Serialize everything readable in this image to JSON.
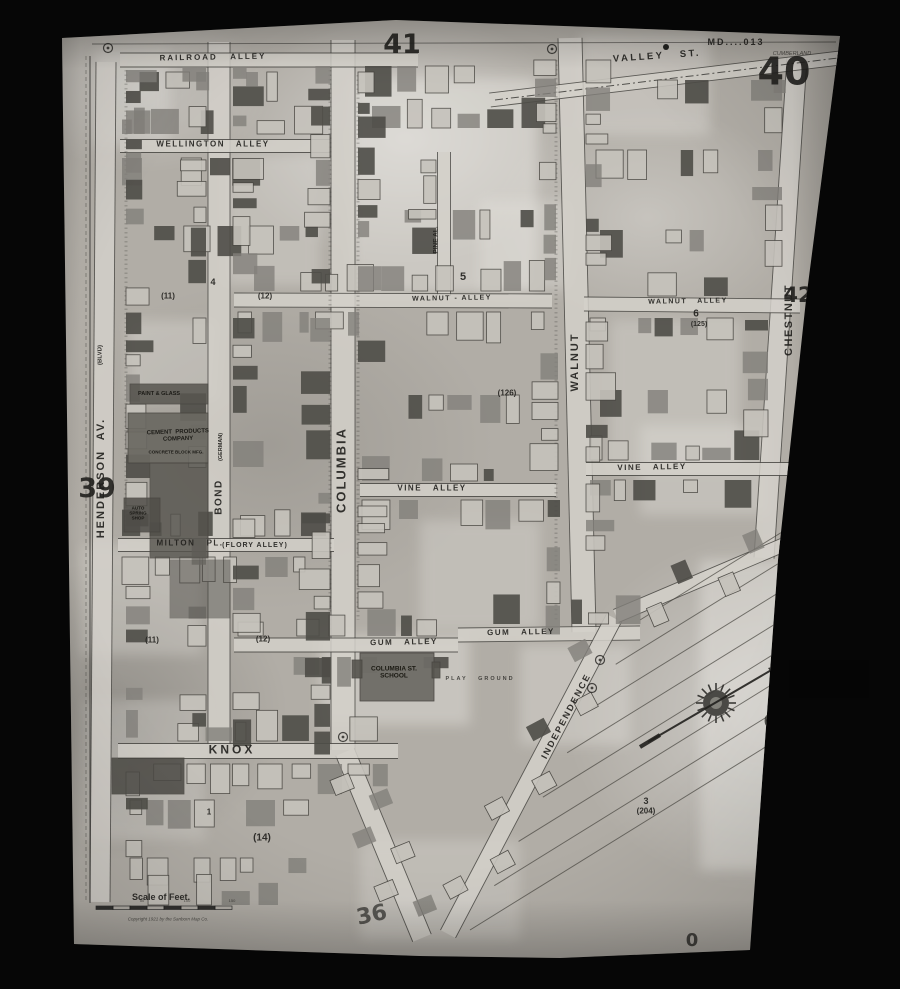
{
  "map_meta": {
    "catalog_number": "MD....013",
    "city": "CUMBERLAND",
    "sheet_number": "40",
    "adjacent_sheets": [
      "39",
      "41",
      "42",
      "36"
    ],
    "scale_label": "Scale of Feet.",
    "scale_ticks": [
      "50",
      "100",
      "150"
    ],
    "copyright": "Copyright 1921 by the Sanborn Map Co."
  },
  "labels": [
    {
      "name": "catalog-number",
      "text": "MD....013",
      "x": 736,
      "y": 42,
      "fs": 9,
      "ls": 2,
      "w": 700
    },
    {
      "name": "city-name",
      "text": "CUMBERLAND",
      "x": 792,
      "y": 54,
      "fs": 5.5,
      "it": 1,
      "o": 0.7
    },
    {
      "name": "sheet-number-40",
      "text": "40",
      "x": 784,
      "y": 72,
      "fs": 38,
      "w": 700,
      "num": 1
    },
    {
      "name": "sheet-number-41",
      "text": "41",
      "x": 402,
      "y": 45,
      "fs": 27,
      "w": 600,
      "num": 1
    },
    {
      "name": "sheet-number-42",
      "text": "42",
      "x": 798,
      "y": 296,
      "fs": 21,
      "w": 600,
      "num": 1
    },
    {
      "name": "sheet-number-39",
      "text": "39",
      "x": 97,
      "y": 489,
      "fs": 27,
      "w": 600,
      "num": 1
    },
    {
      "name": "sheet-number-36",
      "text": "36",
      "x": 372,
      "y": 916,
      "rot": -12,
      "fs": 22,
      "w": 600,
      "o": 0.65,
      "num": 1
    },
    {
      "name": "street-railroad-alley",
      "text": "RAILROAD   ALLEY",
      "x": 213,
      "y": 58,
      "rot": -1,
      "fs": 8,
      "ls": 2,
      "w": 600
    },
    {
      "name": "street-wellington-alley",
      "text": "WELLINGTON   ALLEY",
      "x": 213,
      "y": 145,
      "fs": 8,
      "ls": 1.5,
      "w": 600
    },
    {
      "name": "street-valley",
      "text": "VALLEY   ST.",
      "x": 657,
      "y": 57,
      "rot": -4,
      "fs": 9.5,
      "ls": 2.5,
      "w": 700
    },
    {
      "name": "street-walnut-alley-left",
      "text": "WALNUT - ALLEY",
      "x": 452,
      "y": 299,
      "rot": -1,
      "fs": 7,
      "ls": 1.5,
      "w": 600
    },
    {
      "name": "street-walnut-alley-right",
      "text": "WALNUT   ALLEY",
      "x": 688,
      "y": 302,
      "rot": -1,
      "fs": 7,
      "ls": 1.5,
      "w": 600
    },
    {
      "name": "street-vine-alley-left",
      "text": "VINE   ALLEY",
      "x": 432,
      "y": 489,
      "fs": 8,
      "ls": 1.5,
      "w": 600
    },
    {
      "name": "street-vine-alley-right",
      "text": "VINE   ALLEY",
      "x": 652,
      "y": 468,
      "rot": -1,
      "fs": 8,
      "ls": 1.5,
      "w": 600
    },
    {
      "name": "street-gum-alley-left",
      "text": "GUM   ALLEY",
      "x": 404,
      "y": 643,
      "rot": -1,
      "fs": 8,
      "ls": 1.5,
      "w": 600
    },
    {
      "name": "street-gum-alley-right",
      "text": "GUM   ALLEY",
      "x": 521,
      "y": 633,
      "rot": -1,
      "fs": 8,
      "ls": 1.5,
      "w": 600
    },
    {
      "name": "street-milton-pl",
      "text": "MILTON   PL.",
      "x": 190,
      "y": 544,
      "fs": 8,
      "ls": 1.5,
      "w": 600
    },
    {
      "name": "street-flory-alley",
      "text": "(FLORY ALLEY)",
      "x": 255,
      "y": 546,
      "fs": 7,
      "ls": 1,
      "w": 600
    },
    {
      "name": "street-knox",
      "text": "KNOX",
      "x": 232,
      "y": 750,
      "fs": 12,
      "ls": 3,
      "w": 700
    },
    {
      "name": "street-henderson-av",
      "text": "HENDERSON  AV.",
      "x": 101,
      "y": 478,
      "rot": -90,
      "fs": 11,
      "ls": 2,
      "w": 600
    },
    {
      "name": "street-henderson-blvd",
      "text": "(BLVD)",
      "x": 101,
      "y": 355,
      "rot": -90,
      "fs": 6,
      "w": 600
    },
    {
      "name": "street-bond",
      "text": "BOND",
      "x": 219,
      "y": 497,
      "rot": -90,
      "fs": 10,
      "ls": 1.5,
      "w": 600
    },
    {
      "name": "street-bond-german",
      "text": "(GERMAN)",
      "x": 221,
      "y": 447,
      "rot": -90,
      "fs": 5.5,
      "w": 600
    },
    {
      "name": "street-columbia",
      "text": "COLUMBIA",
      "x": 342,
      "y": 470,
      "rot": -90,
      "fs": 13,
      "ls": 2,
      "w": 700
    },
    {
      "name": "street-pine-alley",
      "text": "PINE AL.",
      "x": 436,
      "y": 240,
      "rot": -90,
      "fs": 6.5,
      "w": 600
    },
    {
      "name": "street-walnut",
      "text": "WALNUT",
      "x": 575,
      "y": 362,
      "rot": -90,
      "fs": 11,
      "ls": 2,
      "w": 600
    },
    {
      "name": "street-chestnut",
      "text": "CHESTNUT",
      "x": 789,
      "y": 320,
      "rot": -90,
      "fs": 11,
      "ls": 1.5,
      "w": 600
    },
    {
      "name": "street-independence",
      "text": "INDEPENDENCE",
      "x": 566,
      "y": 716,
      "rot": -62,
      "fs": 9,
      "ls": 2,
      "w": 600
    },
    {
      "name": "street-high",
      "text": "HIGH",
      "x": 769,
      "y": 866,
      "rot": -78,
      "fs": 7,
      "w": 600,
      "o": 0.6
    },
    {
      "name": "street-hill",
      "text": "HILL",
      "x": 767,
      "y": 792,
      "rot": -78,
      "fs": 7,
      "w": 600,
      "o": 0.6
    },
    {
      "name": "block-number-11-upper",
      "text": "(11)",
      "x": 168,
      "y": 297,
      "fs": 8,
      "w": 600
    },
    {
      "name": "block-number-12-upper",
      "text": "(12)",
      "x": 265,
      "y": 297,
      "fs": 8,
      "w": 600
    },
    {
      "name": "block-number-4",
      "text": "4",
      "x": 213,
      "y": 282,
      "fs": 9,
      "w": 600
    },
    {
      "name": "block-number-5",
      "text": "5",
      "x": 463,
      "y": 277,
      "fs": 11,
      "w": 700
    },
    {
      "name": "block-number-11-lower",
      "text": "(11)",
      "x": 152,
      "y": 641,
      "fs": 8,
      "w": 600
    },
    {
      "name": "block-number-12-lower",
      "text": "(12)",
      "x": 263,
      "y": 640,
      "fs": 8,
      "w": 600
    },
    {
      "name": "block-number-6",
      "text": "6",
      "x": 696,
      "y": 314,
      "fs": 10,
      "w": 700
    },
    {
      "name": "block-number-125",
      "text": "(125)",
      "x": 699,
      "y": 325,
      "fs": 7,
      "w": 600
    },
    {
      "name": "block-number-126",
      "text": "(126)",
      "x": 507,
      "y": 394,
      "fs": 8,
      "w": 600
    },
    {
      "name": "block-number-14",
      "text": "(14)",
      "x": 262,
      "y": 838,
      "fs": 10,
      "w": 600
    },
    {
      "name": "block-number-3",
      "text": "3",
      "x": 646,
      "y": 801,
      "fs": 9,
      "w": 600
    },
    {
      "name": "block-number-204",
      "text": "(204)",
      "x": 646,
      "y": 812,
      "fs": 8,
      "w": 600
    },
    {
      "name": "block-number-0-east",
      "text": "0",
      "x": 770,
      "y": 722,
      "fs": 18,
      "w": 600,
      "num": 1,
      "o": 0.75
    },
    {
      "name": "block-number-0-south",
      "text": "0",
      "x": 692,
      "y": 941,
      "fs": 18,
      "w": 600,
      "num": 1,
      "o": 0.75
    },
    {
      "name": "block-number-1",
      "text": "1",
      "x": 209,
      "y": 813,
      "fs": 8,
      "w": 600
    },
    {
      "name": "label-cement-products",
      "text": "CEMENT  PRODUCTS\nCOMPANY",
      "x": 178,
      "y": 436,
      "rot": -2,
      "fs": 6,
      "w": 700,
      "c": "#14130f"
    },
    {
      "name": "label-concrete-block-mfg",
      "text": "CONCRETE BLOCK MFG.",
      "x": 176,
      "y": 452,
      "fs": 4.5,
      "w": 600,
      "c": "#14130f"
    },
    {
      "name": "label-paint-glass",
      "text": "PAINT & GLASS",
      "x": 159,
      "y": 394,
      "fs": 5.5,
      "w": 600,
      "c": "#14130f"
    },
    {
      "name": "label-auto-spring-shop",
      "text": "AUTO\nSPRING\nSHOP",
      "x": 138,
      "y": 513,
      "fs": 4.5,
      "w": 600,
      "c": "#14130f"
    },
    {
      "name": "label-columbia-st-school",
      "text": "COLUMBIA ST.\nSCHOOL",
      "x": 394,
      "y": 673,
      "fs": 6.5,
      "w": 700,
      "c": "#111009"
    },
    {
      "name": "label-play-ground",
      "text": "PLAY   GROUND",
      "x": 480,
      "y": 679,
      "fs": 5.5,
      "ls": 2,
      "w": 600,
      "o": 0.75
    },
    {
      "name": "scale-of-feet-label",
      "text": "Scale of Feet.",
      "x": 161,
      "y": 897,
      "fs": 9,
      "w": 600
    },
    {
      "name": "scale-tick-50",
      "text": "50",
      "x": 142,
      "y": 901,
      "fs": 4,
      "o": 0.7
    },
    {
      "name": "scale-tick-100",
      "text": "100",
      "x": 187,
      "y": 901,
      "fs": 4,
      "o": 0.7
    },
    {
      "name": "scale-tick-150",
      "text": "150",
      "x": 232,
      "y": 901,
      "fs": 4,
      "o": 0.7
    },
    {
      "name": "copyright-line",
      "text": "Copyright 1921 by the Sanborn Map Co.",
      "x": 168,
      "y": 919,
      "fs": 4.5,
      "it": 1,
      "o": 0.7
    }
  ]
}
